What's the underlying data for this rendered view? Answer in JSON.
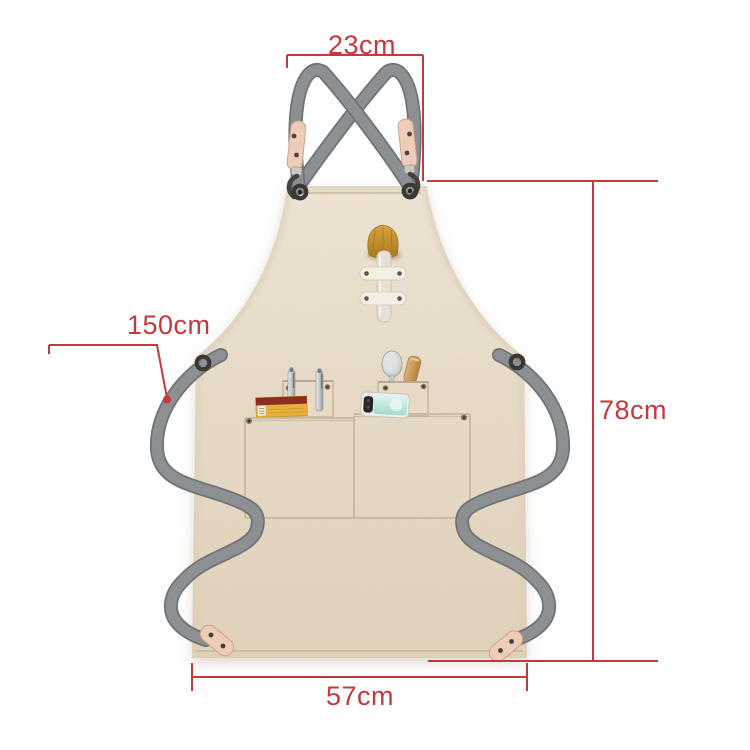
{
  "product_diagram": {
    "kind": "apron-size-diagram",
    "annotations": {
      "top_width": {
        "label": "23cm"
      },
      "strap_length": {
        "label": "150cm"
      },
      "height": {
        "label": "78cm"
      },
      "bottom_width": {
        "label": "57cm"
      }
    }
  },
  "colors": {
    "accent": "#c23a3e",
    "background": "#ffffff",
    "fabric": "#e8dcc9",
    "fabric-deep": "#ddcdb6",
    "stitch": "#c9b79c",
    "strap": "#8d9092",
    "strap-dark": "#707376",
    "leather": "#efccba",
    "leather-edge": "#cfa28c",
    "metal": "#46433f",
    "wood": "#c79e62",
    "brush": "#c3902f",
    "box-yellow": "#e6b13b",
    "box-red": "#8e2c24",
    "phone-screen": "#c0e9e1"
  }
}
